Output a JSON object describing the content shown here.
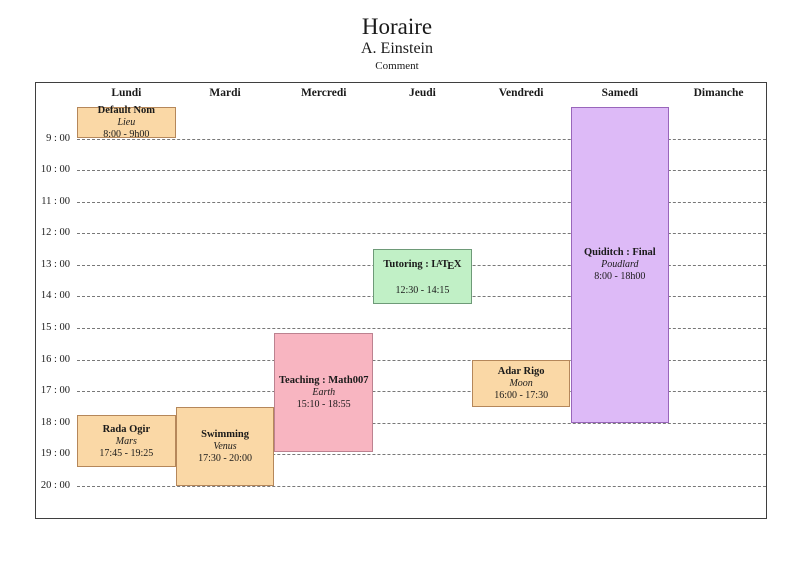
{
  "title": {
    "main": "Horaire",
    "author": "A. Einstein",
    "comment": "Comment"
  },
  "days": [
    "Lundi",
    "Mardi",
    "Mercredi",
    "Jeudi",
    "Vendredi",
    "Samedi",
    "Dimanche"
  ],
  "hour_labels": [
    "9 : 00",
    "10 : 00",
    "11 : 00",
    "12 : 00",
    "13 : 00",
    "14 : 00",
    "15 : 00",
    "16 : 00",
    "17 : 00",
    "18 : 00",
    "19 : 00",
    "20 : 00"
  ],
  "grid": {
    "hour_start": 9,
    "hour_end": 20
  },
  "colors": {
    "orange": {
      "fill": "#FAD8A6",
      "border": "#B5875A"
    },
    "pink": {
      "fill": "#F8B5C1",
      "border": "#BC8290"
    },
    "green": {
      "fill": "#C1F0C6",
      "border": "#6E9A78"
    },
    "purple": {
      "fill": "#DDBAF7",
      "border": "#9966BB"
    },
    "hour_line": "#787878",
    "frame": "#3F3F3F"
  },
  "events": [
    {
      "title": "Default Nom",
      "location": "Lieu",
      "time": "8:00 - 9h00",
      "day": "Lundi",
      "start": 8.0,
      "end": 9.0,
      "color": "orange"
    },
    {
      "title": "Rada Ogir",
      "location": "Mars",
      "time": "17:45 - 19:25",
      "day": "Lundi",
      "start": 17.75,
      "end": 19.4167,
      "color": "orange"
    },
    {
      "title": "Swimming",
      "location": "Venus",
      "time": "17:30 - 20:00",
      "day": "Mardi",
      "start": 17.5,
      "end": 20.0,
      "color": "orange"
    },
    {
      "title": "Teaching : Math007",
      "location": "Earth",
      "time": "15:10 - 18:55",
      "day": "Mercredi",
      "start": 15.1667,
      "end": 18.9167,
      "color": "pink"
    },
    {
      "title": "Tutoring : LaTeX",
      "location": "",
      "time": "12:30 - 14:15",
      "day": "Jeudi",
      "start": 12.5,
      "end": 14.25,
      "color": "green",
      "latex_logo": true
    },
    {
      "title": "Adar Rigo",
      "location": "Moon",
      "time": "16:00 - 17:30",
      "day": "Vendredi",
      "start": 16.0,
      "end": 17.5,
      "color": "orange"
    },
    {
      "title": "Quiditch : Final",
      "location": "Poudlard",
      "time": "8:00 - 18h00",
      "day": "Samedi",
      "start": 8.0,
      "end": 18.0,
      "color": "purple"
    }
  ]
}
